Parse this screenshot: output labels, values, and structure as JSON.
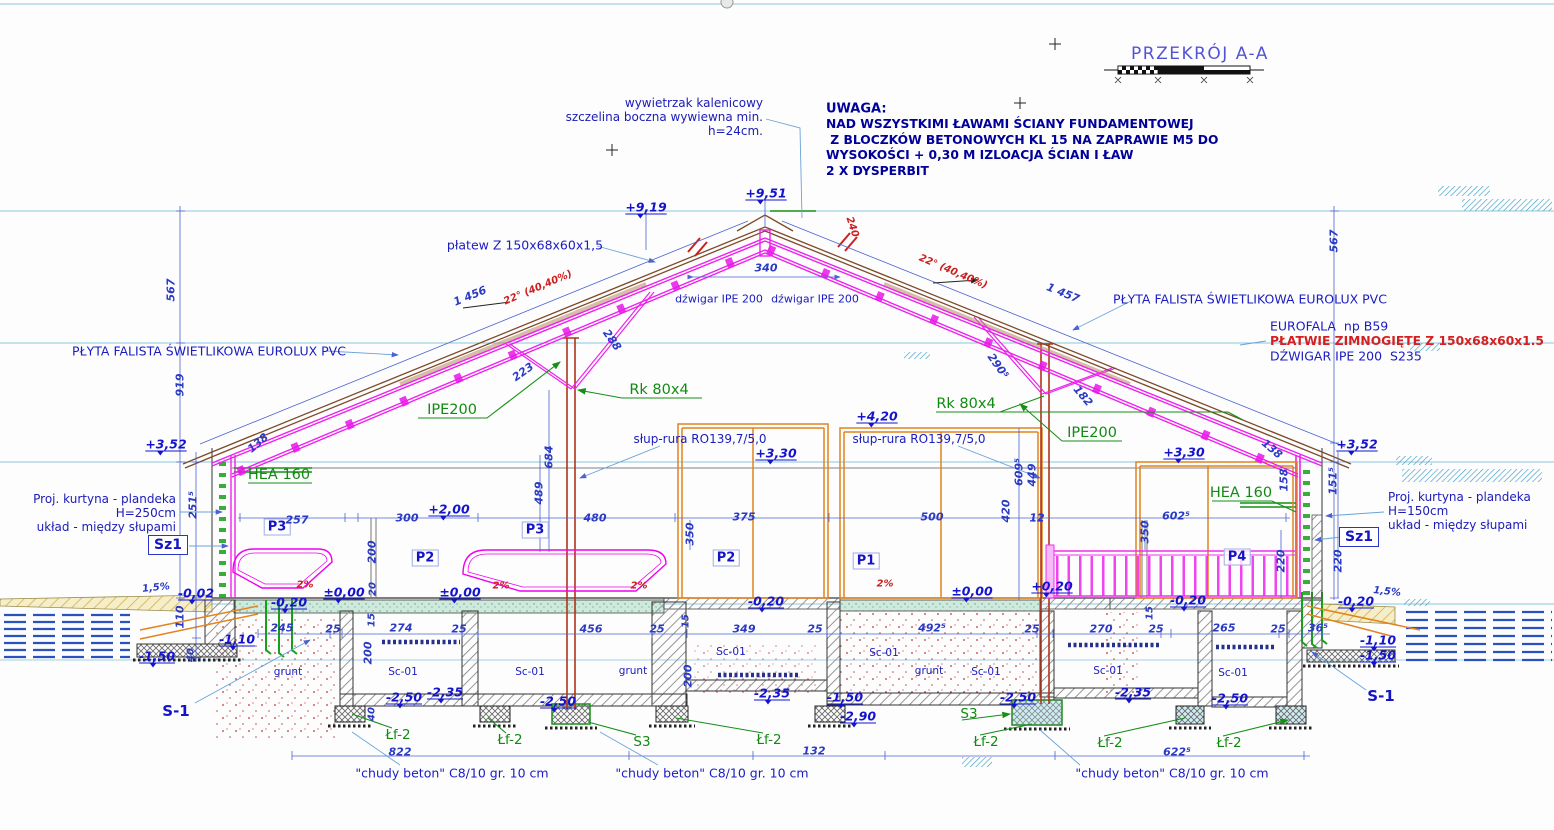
{
  "title": {
    "text": "PRZEKRÓJ A-A"
  },
  "labels": [
    {
      "t": "wywietrzak kalenicowy\nszczelina boczna wywiewna min.\nh=24cm.",
      "x": 763,
      "y": 117,
      "c": "note ta-r",
      "a": "r",
      "n": "ridge-vent-note"
    },
    {
      "t": "UWAGA:",
      "x": 826,
      "y": 109,
      "c": "noteb",
      "a": "l",
      "n": "uwaga-heading"
    },
    {
      "t": "NAD WSZYSTKIMI ŁAWAMI ŚCIANY FUNDAMENTOWEJ\n Z BLOCZKÓW BETONOWYCH KL 15 NA ZAPRAWIE M5 DO\nWYSOKOŚCI + 0,30 M IZLOACJA ŚCIAN I ŁAW\n2 X DYSPERBIT",
      "x": 826,
      "y": 148,
      "c": "noteb2",
      "a": "l",
      "n": "uwaga-body"
    },
    {
      "t": "Proj. kurtyna - plandeka\nH=250cm\nukład - między słupami",
      "x": 176,
      "y": 513,
      "c": "note ta-r",
      "a": "r",
      "n": "curtain-note-left"
    },
    {
      "t": "Proj. kurtyna - plandeka\nH=150cm\nukład - między słupami",
      "x": 1388,
      "y": 511,
      "c": "note",
      "a": "l",
      "n": "curtain-note-right"
    },
    {
      "t": "płatew Z 150x68x60x1,5",
      "x": 525,
      "y": 245,
      "c": "lblb",
      "n": "purlin-label"
    },
    {
      "t": "dźwigar IPE 200",
      "x": 719,
      "y": 299,
      "c": "lbls2",
      "n": "girder-label"
    },
    {
      "t": "dźwigar IPE 200",
      "x": 815,
      "y": 299,
      "c": "lbls2",
      "n": "girder-label"
    },
    {
      "t": "PŁYTA FALISTA ŚWIETLIKOWA EUROLUX PVC",
      "x": 209,
      "y": 351,
      "c": "lblb",
      "n": "skylight-panel-label"
    },
    {
      "t": "PŁYTA FALISTA ŚWIETLIKOWA EUROLUX PVC",
      "x": 1250,
      "y": 299,
      "c": "lblb",
      "n": "skylight-panel-label"
    },
    {
      "t": "EUROFALA  np B59",
      "x": 1270,
      "y": 326,
      "c": "lblb",
      "a": "l",
      "n": "roof-sheet-label"
    },
    {
      "t": "PŁATWIE ZIMNOGIĘTE Z 150x68x60x1.5",
      "x": 1270,
      "y": 341,
      "c": "redb",
      "a": "l",
      "n": "cold-formed-purlin-label"
    },
    {
      "t": "DŹWIGAR IPE 200  S235",
      "x": 1270,
      "y": 356,
      "c": "lblb",
      "a": "l",
      "n": "girder-steel-label"
    },
    {
      "t": "słup-rura RO139,7/5,0",
      "x": 700,
      "y": 439,
      "c": "lbl-n",
      "n": "pipe-column-label"
    },
    {
      "t": "słup-rura RO139,7/5,0",
      "x": 919,
      "y": 439,
      "c": "lbl-n",
      "n": "pipe-column-label"
    },
    {
      "t": "IPE200",
      "x": 452,
      "y": 410,
      "c": "grn",
      "n": "ipe200-label"
    },
    {
      "t": "IPE200",
      "x": 1092,
      "y": 433,
      "c": "grn",
      "n": "ipe200-label"
    },
    {
      "t": "Rk 80x4",
      "x": 659,
      "y": 390,
      "c": "grn",
      "n": "brace-label"
    },
    {
      "t": "Rk 80x4",
      "x": 966,
      "y": 404,
      "c": "grn",
      "n": "brace-label"
    },
    {
      "t": "HEA 160",
      "x": 279,
      "y": 475,
      "c": "grn",
      "n": "hea160-label"
    },
    {
      "t": "HEA 160",
      "x": 1241,
      "y": 493,
      "c": "grn",
      "n": "hea160-label"
    },
    {
      "t": "Sz1",
      "x": 168,
      "y": 545,
      "c": "boxed",
      "n": "wall-type-label"
    },
    {
      "t": "Sz1",
      "x": 1359,
      "y": 537,
      "c": "boxed",
      "n": "wall-type-label"
    },
    {
      "t": "P3",
      "x": 277,
      "y": 527,
      "c": "pbox",
      "n": "panel-label"
    },
    {
      "t": "P3",
      "x": 535,
      "y": 530,
      "c": "pbox",
      "n": "panel-label"
    },
    {
      "t": "P2",
      "x": 425,
      "y": 558,
      "c": "pbox",
      "n": "panel-label"
    },
    {
      "t": "P2",
      "x": 726,
      "y": 558,
      "c": "pbox",
      "n": "panel-label"
    },
    {
      "t": "P1",
      "x": 866,
      "y": 561,
      "c": "pbox",
      "n": "panel-label"
    },
    {
      "t": "P4",
      "x": 1237,
      "y": 557,
      "c": "pbox",
      "n": "panel-label"
    },
    {
      "t": "S-1",
      "x": 176,
      "y": 711,
      "c": "s1",
      "n": "footing-label"
    },
    {
      "t": "S-1",
      "x": 1381,
      "y": 696,
      "c": "s1",
      "n": "footing-label"
    },
    {
      "t": "S3",
      "x": 642,
      "y": 742,
      "c": "grns",
      "n": "footing-label"
    },
    {
      "t": "S3",
      "x": 969,
      "y": 714,
      "c": "grns",
      "n": "footing-label"
    },
    {
      "t": "Łf-2",
      "x": 398,
      "y": 735,
      "c": "grns",
      "n": "footing-label"
    },
    {
      "t": "Łf-2",
      "x": 510,
      "y": 740,
      "c": "grns",
      "n": "footing-label"
    },
    {
      "t": "Łf-2",
      "x": 769,
      "y": 740,
      "c": "grns",
      "n": "footing-label"
    },
    {
      "t": "Łf-2",
      "x": 986,
      "y": 742,
      "c": "grns",
      "n": "footing-label"
    },
    {
      "t": "Łf-2",
      "x": 1110,
      "y": 743,
      "c": "grns",
      "n": "footing-label"
    },
    {
      "t": "Łf-2",
      "x": 1229,
      "y": 743,
      "c": "grns",
      "n": "footing-label"
    },
    {
      "t": "Sc-01",
      "x": 403,
      "y": 672,
      "c": "lbls",
      "n": "channel-label"
    },
    {
      "t": "Sc-01",
      "x": 530,
      "y": 672,
      "c": "lbls",
      "n": "channel-label"
    },
    {
      "t": "Sc-01",
      "x": 731,
      "y": 652,
      "c": "lbls",
      "n": "channel-label"
    },
    {
      "t": "Sc-01",
      "x": 884,
      "y": 653,
      "c": "lbls",
      "n": "channel-label"
    },
    {
      "t": "Sc-01",
      "x": 986,
      "y": 672,
      "c": "lbls",
      "n": "channel-label"
    },
    {
      "t": "Sc-01",
      "x": 1108,
      "y": 671,
      "c": "lbls",
      "n": "channel-label"
    },
    {
      "t": "Sc-01",
      "x": 1233,
      "y": 673,
      "c": "lbls",
      "n": "channel-label"
    },
    {
      "t": "grunt",
      "x": 288,
      "y": 672,
      "c": "lbls",
      "n": "soil-label"
    },
    {
      "t": "grunt",
      "x": 633,
      "y": 671,
      "c": "lbls",
      "n": "soil-label"
    },
    {
      "t": "grunt",
      "x": 929,
      "y": 671,
      "c": "lbls",
      "n": "soil-label"
    },
    {
      "t": "\"chudy beton\" C8/10 gr. 10 cm",
      "x": 452,
      "y": 773,
      "c": "lblb",
      "n": "lean-concrete-note"
    },
    {
      "t": "\"chudy beton\" C8/10 gr. 10 cm",
      "x": 712,
      "y": 773,
      "c": "lblb",
      "n": "lean-concrete-note"
    },
    {
      "t": "\"chudy beton\" C8/10 gr. 10 cm",
      "x": 1172,
      "y": 773,
      "c": "lblb",
      "n": "lean-concrete-note"
    },
    {
      "t": "+9,51",
      "x": 766,
      "y": 193,
      "c": "el",
      "n": "elevation-mark"
    },
    {
      "t": "+9,19",
      "x": 646,
      "y": 207,
      "c": "el",
      "n": "elevation-mark"
    },
    {
      "t": "+3,52",
      "x": 166,
      "y": 444,
      "c": "el",
      "n": "elevation-mark"
    },
    {
      "t": "+3,52",
      "x": 1357,
      "y": 444,
      "c": "el",
      "n": "elevation-mark"
    },
    {
      "t": "+2,00",
      "x": 449,
      "y": 509,
      "c": "el",
      "n": "elevation-mark"
    },
    {
      "t": "+4,20",
      "x": 877,
      "y": 416,
      "c": "el",
      "n": "elevation-mark"
    },
    {
      "t": "+3,30",
      "x": 776,
      "y": 453,
      "c": "el",
      "n": "elevation-mark"
    },
    {
      "t": "+3,30",
      "x": 1184,
      "y": 452,
      "c": "el",
      "n": "elevation-mark"
    },
    {
      "t": "±0,00",
      "x": 344,
      "y": 592,
      "c": "el",
      "n": "elevation-mark"
    },
    {
      "t": "±0,00",
      "x": 460,
      "y": 592,
      "c": "el",
      "n": "elevation-mark"
    },
    {
      "t": "±0,00",
      "x": 972,
      "y": 591,
      "c": "el",
      "n": "elevation-mark"
    },
    {
      "t": "+0,20",
      "x": 1052,
      "y": 586,
      "c": "el",
      "n": "elevation-mark"
    },
    {
      "t": "-0,02",
      "x": 196,
      "y": 593,
      "c": "el",
      "n": "elevation-mark"
    },
    {
      "t": "-0,20",
      "x": 289,
      "y": 602,
      "c": "el",
      "n": "elevation-mark"
    },
    {
      "t": "-0,20",
      "x": 766,
      "y": 601,
      "c": "el",
      "n": "elevation-mark"
    },
    {
      "t": "-0,20",
      "x": 1188,
      "y": 600,
      "c": "el",
      "n": "elevation-mark"
    },
    {
      "t": "-0,20",
      "x": 1356,
      "y": 601,
      "c": "el",
      "n": "elevation-mark"
    },
    {
      "t": "-1,10",
      "x": 237,
      "y": 639,
      "c": "el",
      "n": "elevation-mark"
    },
    {
      "t": "-1,10",
      "x": 1378,
      "y": 640,
      "c": "el",
      "n": "elevation-mark"
    },
    {
      "t": "-1,50",
      "x": 157,
      "y": 656,
      "c": "el",
      "n": "elevation-mark"
    },
    {
      "t": "-1,50",
      "x": 1378,
      "y": 655,
      "c": "el",
      "n": "elevation-mark"
    },
    {
      "t": "-1,50",
      "x": 845,
      "y": 697,
      "c": "el",
      "n": "elevation-mark"
    },
    {
      "t": "-2,50",
      "x": 404,
      "y": 697,
      "c": "el",
      "n": "elevation-mark"
    },
    {
      "t": "-2,50",
      "x": 558,
      "y": 701,
      "c": "el",
      "n": "elevation-mark"
    },
    {
      "t": "-2,50",
      "x": 1018,
      "y": 697,
      "c": "el",
      "n": "elevation-mark"
    },
    {
      "t": "-2,50",
      "x": 1230,
      "y": 698,
      "c": "el",
      "n": "elevation-mark"
    },
    {
      "t": "-2,35",
      "x": 445,
      "y": 692,
      "c": "el",
      "n": "elevation-mark"
    },
    {
      "t": "-2,35",
      "x": 772,
      "y": 693,
      "c": "el",
      "n": "elevation-mark"
    },
    {
      "t": "-2,35",
      "x": 1133,
      "y": 692,
      "c": "el",
      "n": "elevation-mark"
    },
    {
      "t": "-2,90",
      "x": 858,
      "y": 716,
      "c": "el",
      "n": "elevation-mark"
    },
    {
      "t": "22° (40,40%)",
      "x": 538,
      "y": 288,
      "c": "red",
      "r": -23,
      "n": "slope-label"
    },
    {
      "t": "22° (40,40%)",
      "x": 953,
      "y": 272,
      "c": "red",
      "r": 23,
      "n": "slope-label"
    },
    {
      "t": "240",
      "x": 852,
      "y": 227,
      "c": "red",
      "r": 72,
      "n": "slope-dim"
    },
    {
      "t": "1 456",
      "x": 470,
      "y": 296,
      "c": "dim",
      "r": -22,
      "n": "dimension"
    },
    {
      "t": "1 457",
      "x": 1063,
      "y": 293,
      "c": "dim",
      "r": 22,
      "n": "dimension"
    },
    {
      "t": "340",
      "x": 766,
      "y": 268,
      "c": "dim",
      "n": "dimension"
    },
    {
      "t": "567",
      "x": 171,
      "y": 290,
      "c": "dim",
      "r": -90,
      "n": "dimension"
    },
    {
      "t": "919",
      "x": 180,
      "y": 385,
      "c": "dim",
      "r": -90,
      "n": "dimension"
    },
    {
      "t": "567",
      "x": 1334,
      "y": 241,
      "c": "dim",
      "r": -90,
      "n": "dimension"
    },
    {
      "t": "223",
      "x": 523,
      "y": 372,
      "c": "dim",
      "r": -35,
      "n": "dimension"
    },
    {
      "t": "288",
      "x": 612,
      "y": 340,
      "c": "dim",
      "r": 55,
      "n": "dimension"
    },
    {
      "t": "290⁵",
      "x": 998,
      "y": 366,
      "c": "dim",
      "r": 55,
      "n": "dimension"
    },
    {
      "t": "182",
      "x": 1083,
      "y": 396,
      "c": "dim",
      "r": 50,
      "n": "dimension"
    },
    {
      "t": "138",
      "x": 258,
      "y": 443,
      "c": "dim",
      "r": -40,
      "n": "dimension"
    },
    {
      "t": "138",
      "x": 1272,
      "y": 449,
      "c": "dim",
      "r": 40,
      "n": "dimension"
    },
    {
      "t": "684",
      "x": 549,
      "y": 457,
      "c": "dim",
      "r": -90,
      "n": "dimension"
    },
    {
      "t": "489",
      "x": 539,
      "y": 493,
      "c": "dim",
      "r": -90,
      "n": "dimension"
    },
    {
      "t": "251⁵",
      "x": 193,
      "y": 505,
      "c": "dim",
      "r": -90,
      "n": "dimension"
    },
    {
      "t": "151⁵",
      "x": 1333,
      "y": 481,
      "c": "dim",
      "r": -90,
      "n": "dimension"
    },
    {
      "t": "158",
      "x": 1284,
      "y": 480,
      "c": "dim",
      "r": -90,
      "n": "dimension"
    },
    {
      "t": "257",
      "x": 297,
      "y": 520,
      "c": "dim",
      "n": "dimension"
    },
    {
      "t": "300",
      "x": 407,
      "y": 518,
      "c": "dim",
      "n": "dimension"
    },
    {
      "t": "480",
      "x": 595,
      "y": 518,
      "c": "dim",
      "n": "dimension"
    },
    {
      "t": "375",
      "x": 744,
      "y": 517,
      "c": "dim",
      "n": "dimension"
    },
    {
      "t": "500",
      "x": 932,
      "y": 517,
      "c": "dim",
      "n": "dimension"
    },
    {
      "t": "12",
      "x": 1037,
      "y": 518,
      "c": "dim",
      "n": "dimension"
    },
    {
      "t": "602⁵",
      "x": 1176,
      "y": 516,
      "c": "dim",
      "n": "dimension"
    },
    {
      "t": "420",
      "x": 1006,
      "y": 511,
      "c": "dim",
      "r": -90,
      "n": "dimension"
    },
    {
      "t": "609⁵",
      "x": 1019,
      "y": 472,
      "c": "dim",
      "r": -90,
      "n": "dimension"
    },
    {
      "t": "449",
      "x": 1032,
      "y": 475,
      "c": "dim",
      "r": -90,
      "n": "dimension"
    },
    {
      "t": "350",
      "x": 690,
      "y": 534,
      "c": "dim",
      "r": -90,
      "n": "dimension"
    },
    {
      "t": "350",
      "x": 1145,
      "y": 532,
      "c": "dim",
      "r": -90,
      "n": "dimension"
    },
    {
      "t": "200",
      "x": 372,
      "y": 552,
      "c": "dim",
      "r": -90,
      "n": "dimension"
    },
    {
      "t": "20",
      "x": 373,
      "y": 589,
      "c": "dims",
      "r": -90,
      "n": "dimension"
    },
    {
      "t": "220",
      "x": 1281,
      "y": 561,
      "c": "dim",
      "r": -90,
      "n": "dimension"
    },
    {
      "t": "220",
      "x": 1338,
      "y": 561,
      "c": "dim",
      "r": -90,
      "n": "dimension"
    },
    {
      "t": "110",
      "x": 180,
      "y": 617,
      "c": "dim",
      "r": -90,
      "n": "dimension"
    },
    {
      "t": "40",
      "x": 191,
      "y": 655,
      "c": "dims",
      "r": -90,
      "n": "dimension"
    },
    {
      "t": "40",
      "x": 372,
      "y": 714,
      "c": "dims",
      "r": -90,
      "n": "dimension"
    },
    {
      "t": "245",
      "x": 282,
      "y": 628,
      "c": "dim",
      "n": "dimension"
    },
    {
      "t": "25",
      "x": 333,
      "y": 629,
      "c": "dim",
      "n": "dimension"
    },
    {
      "t": "274",
      "x": 401,
      "y": 628,
      "c": "dim",
      "n": "dimension"
    },
    {
      "t": "25",
      "x": 459,
      "y": 629,
      "c": "dim",
      "n": "dimension"
    },
    {
      "t": "456",
      "x": 591,
      "y": 629,
      "c": "dim",
      "n": "dimension"
    },
    {
      "t": "25",
      "x": 657,
      "y": 629,
      "c": "dim",
      "n": "dimension"
    },
    {
      "t": "349",
      "x": 744,
      "y": 629,
      "c": "dim",
      "n": "dimension"
    },
    {
      "t": "25",
      "x": 815,
      "y": 629,
      "c": "dim",
      "n": "dimension"
    },
    {
      "t": "492⁵",
      "x": 932,
      "y": 628,
      "c": "dim",
      "n": "dimension"
    },
    {
      "t": "25",
      "x": 1032,
      "y": 629,
      "c": "dim",
      "n": "dimension"
    },
    {
      "t": "270",
      "x": 1101,
      "y": 629,
      "c": "dim",
      "n": "dimension"
    },
    {
      "t": "25",
      "x": 1156,
      "y": 629,
      "c": "dim",
      "n": "dimension"
    },
    {
      "t": "265",
      "x": 1224,
      "y": 628,
      "c": "dim",
      "n": "dimension"
    },
    {
      "t": "25",
      "x": 1278,
      "y": 629,
      "c": "dim",
      "n": "dimension"
    },
    {
      "t": "36⁵",
      "x": 1318,
      "y": 628,
      "c": "dim",
      "n": "dimension"
    },
    {
      "t": "15",
      "x": 372,
      "y": 620,
      "c": "dims",
      "r": -90,
      "n": "dimension"
    },
    {
      "t": "15",
      "x": 686,
      "y": 621,
      "c": "dims",
      "r": -90,
      "n": "dimension"
    },
    {
      "t": "15",
      "x": 1150,
      "y": 613,
      "c": "dims",
      "r": -90,
      "n": "dimension"
    },
    {
      "t": "200",
      "x": 368,
      "y": 653,
      "c": "dim",
      "r": -90,
      "n": "dimension"
    },
    {
      "t": "200",
      "x": 688,
      "y": 676,
      "c": "dim",
      "r": -90,
      "n": "dimension"
    },
    {
      "t": "822",
      "x": 400,
      "y": 752,
      "c": "dim",
      "n": "dimension"
    },
    {
      "t": "132",
      "x": 814,
      "y": 751,
      "c": "dim",
      "n": "dimension"
    },
    {
      "t": "622⁵",
      "x": 1177,
      "y": 752,
      "c": "dim",
      "n": "dimension"
    },
    {
      "t": "1,5%",
      "x": 156,
      "y": 588,
      "c": "dims",
      "r": -6,
      "n": "slope-dim"
    },
    {
      "t": "1,5%",
      "x": 1387,
      "y": 592,
      "c": "dims",
      "r": 6,
      "n": "slope-dim"
    },
    {
      "t": "2%",
      "x": 305,
      "y": 585,
      "c": "red",
      "n": "slope-dim"
    },
    {
      "t": "2%",
      "x": 501,
      "y": 586,
      "c": "red",
      "n": "slope-dim"
    },
    {
      "t": "2%",
      "x": 639,
      "y": 586,
      "c": "red",
      "n": "slope-dim"
    },
    {
      "t": "2%",
      "x": 885,
      "y": 584,
      "c": "red",
      "n": "slope-dim"
    }
  ]
}
